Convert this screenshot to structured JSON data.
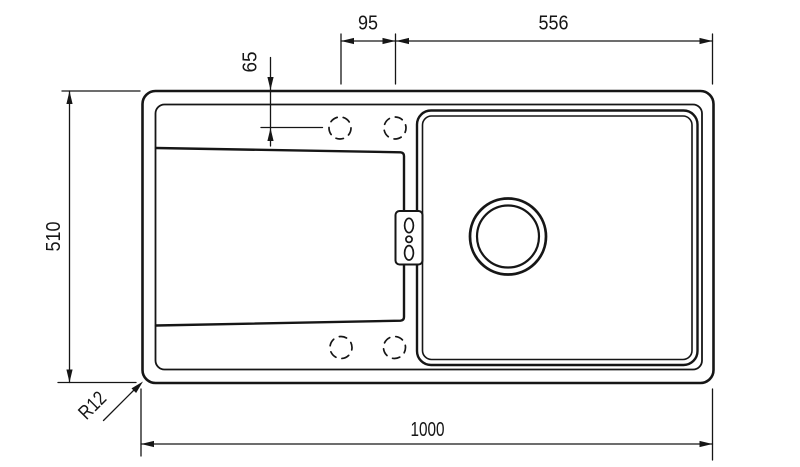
{
  "canvas": {
    "background": "#ffffff",
    "line_color": "#161616"
  },
  "drawing": {
    "view": "sink-top-view",
    "labels": {
      "tap_hole_spacing": "95",
      "bowl_width": "556",
      "tap_hole_offset": "65",
      "overall_depth": "510",
      "overall_length": "1000",
      "corner_radius": "R12"
    }
  }
}
